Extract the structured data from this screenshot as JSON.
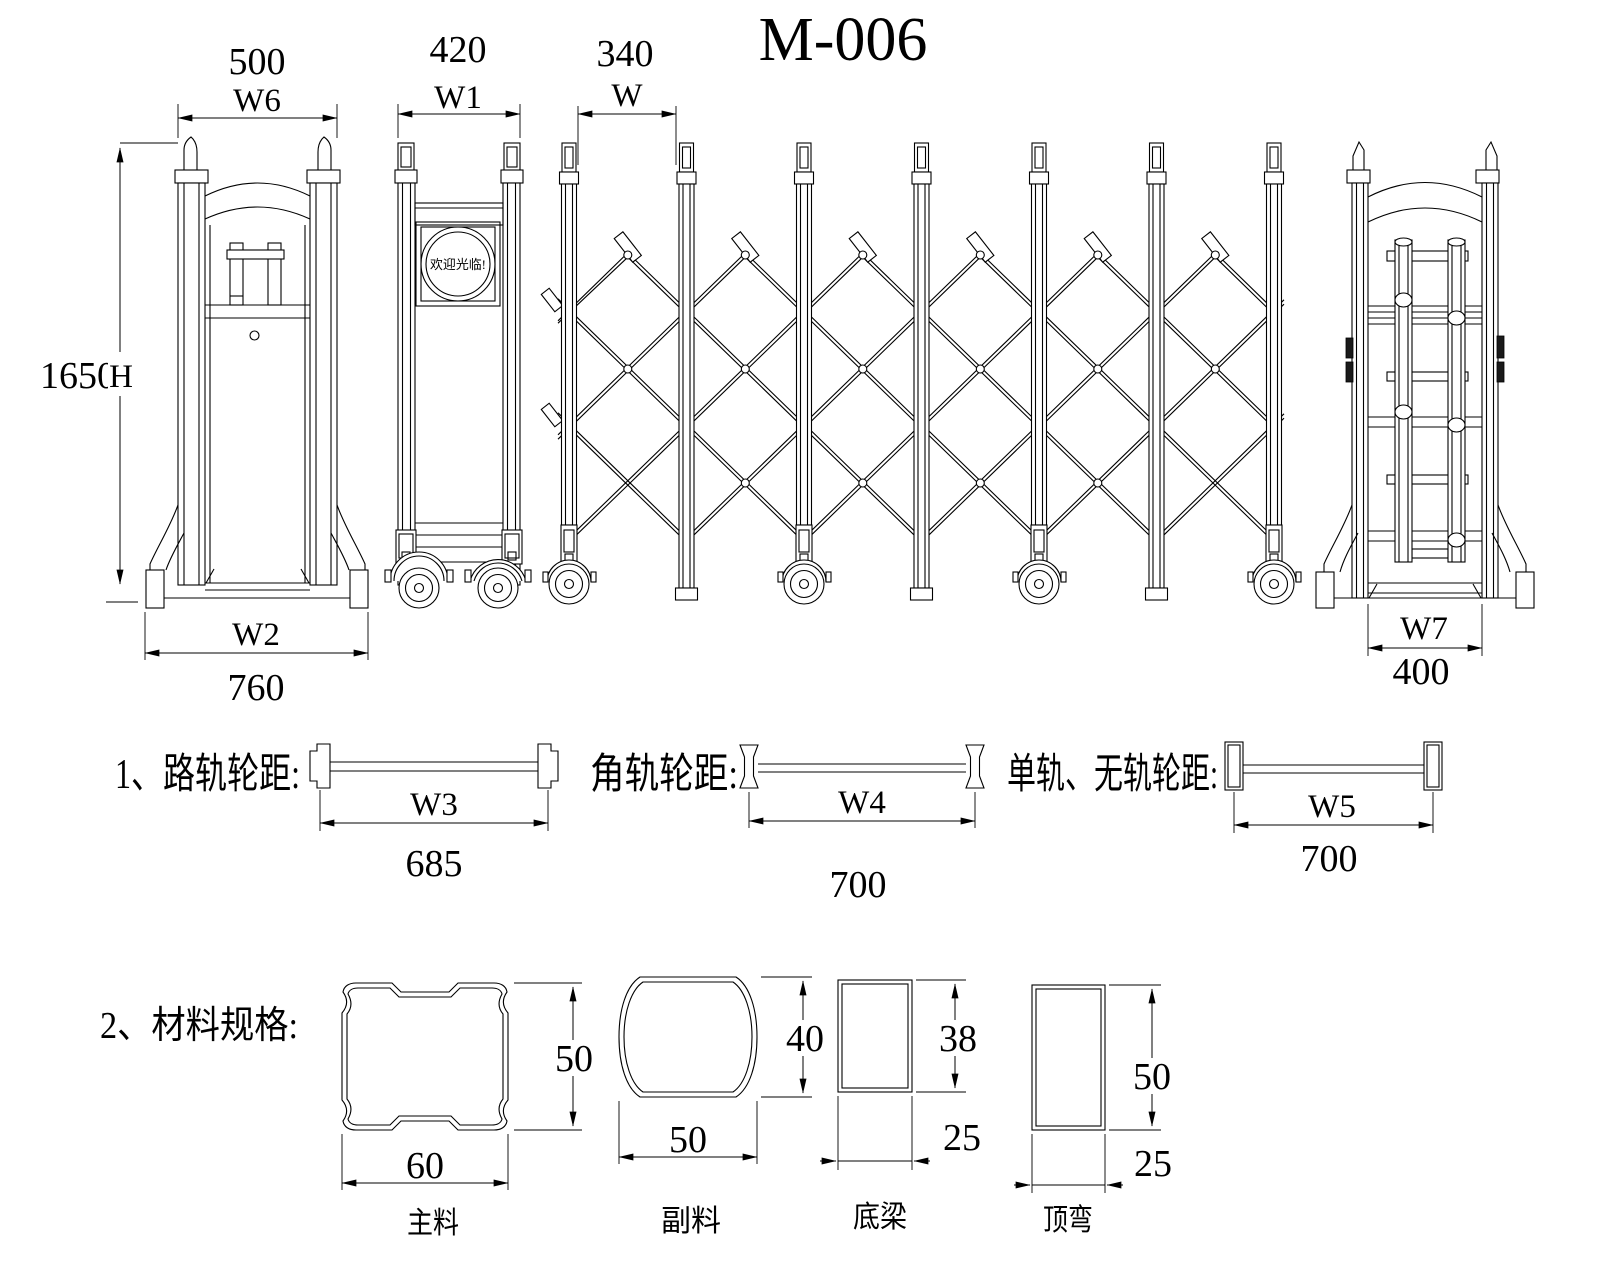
{
  "title": "M-006",
  "front_view": {
    "width_value": "500",
    "width_label": "W6",
    "height_value": "1650",
    "height_label": "H",
    "base_label": "W2",
    "base_value": "760"
  },
  "side_view": {
    "width_value": "420",
    "width_label": "W1",
    "sign_text": "欢迎光临!"
  },
  "gate": {
    "pitch_value": "340",
    "pitch_label": "W"
  },
  "rear_view": {
    "base_label": "W7",
    "base_value": "400"
  },
  "tracks": {
    "item1": {
      "label": "1、路轨轮距:",
      "dim_label": "W3",
      "dim_value": "685"
    },
    "item2": {
      "label": "角轨轮距:",
      "dim_label": "W4",
      "dim_value": "700"
    },
    "item3": {
      "label": "单轨、无轨轮距:",
      "dim_label": "W5",
      "dim_value": "700"
    }
  },
  "materials": {
    "section_label": "2、材料规格:",
    "main": {
      "name": "主料",
      "width": "60",
      "height": "50"
    },
    "aux": {
      "name": "副料",
      "width": "50",
      "height": "40"
    },
    "bottom_beam": {
      "name": "底梁",
      "width": "25",
      "height": "38"
    },
    "top_bend": {
      "name": "顶弯",
      "width": "25",
      "height": "50"
    }
  }
}
